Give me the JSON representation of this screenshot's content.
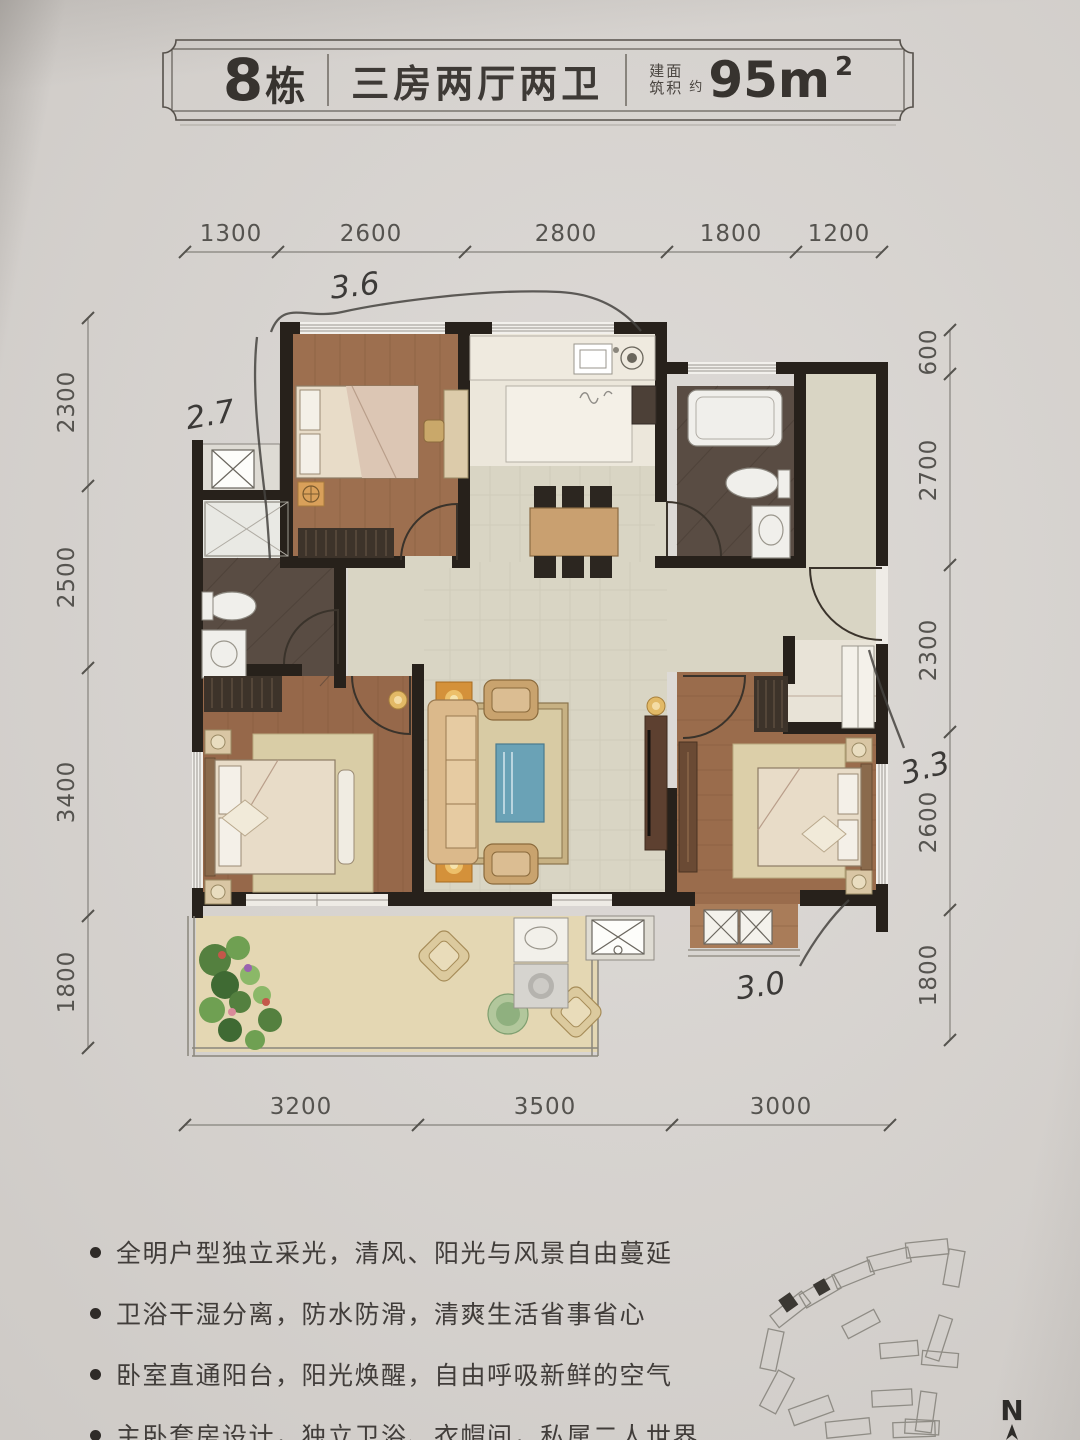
{
  "header": {
    "building_number": "8",
    "building_suffix": "栋",
    "layout": "三房两厅两卫",
    "area_label_top": "建面",
    "area_label_bottom": "筑积",
    "area_approx": "约",
    "area_value": "95m",
    "area_exp": "2"
  },
  "dims": {
    "top": [
      "1300",
      "2600",
      "2800",
      "1800",
      "1200"
    ],
    "left": [
      "2300",
      "2500",
      "3400",
      "1800"
    ],
    "right": [
      "600",
      "2700",
      "2300",
      "2600",
      "1800"
    ],
    "bottom": [
      "3200",
      "3500",
      "3000"
    ]
  },
  "handwritten": {
    "top": "3.6",
    "left": "2.7",
    "right": "3.3",
    "bottom": "3.0"
  },
  "features": [
    "全明户型独立采光，清风、阳光与风景自由蔓延",
    "卫浴干湿分离，防水防滑，清爽生活省事省心",
    "卧室直通阳台，阳光焕醒，自由呼吸新鲜的空气",
    "主卧套房设计，独立卫浴、衣帽间，私属二人世界"
  ],
  "compass": {
    "label": "N"
  },
  "colors": {
    "paper": "#d8d4d0",
    "wall": "#27211b",
    "wood": "#9b6e4e",
    "tile": "#d9d5c4",
    "bath_floor": "#594c43",
    "kitchen_floor": "#ece7db",
    "balcony_floor": "#e4d7b3",
    "rug_blue": "#6aa2b6",
    "lamp_orange": "#d4913a",
    "ink": "#3c3a38",
    "dim_text": "#55534f"
  }
}
